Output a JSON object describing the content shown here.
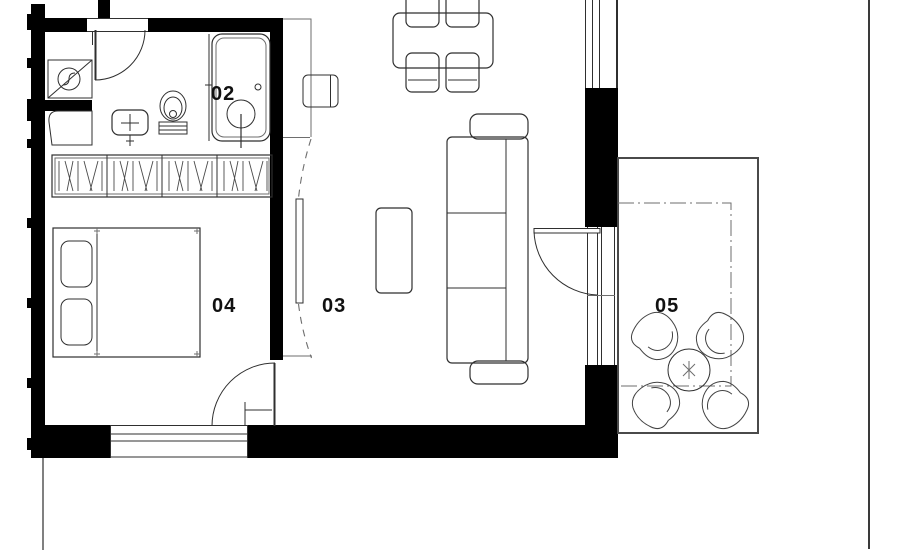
{
  "floor_plan": {
    "rooms": [
      {
        "number": "02"
      },
      {
        "number": "03"
      },
      {
        "number": "04"
      },
      {
        "number": "05"
      }
    ],
    "colors": {
      "wall": "#000000",
      "line": "#2f2f2f",
      "thin_line": "#6e6e6e",
      "label": "#111111",
      "background": "#ffffff"
    }
  }
}
